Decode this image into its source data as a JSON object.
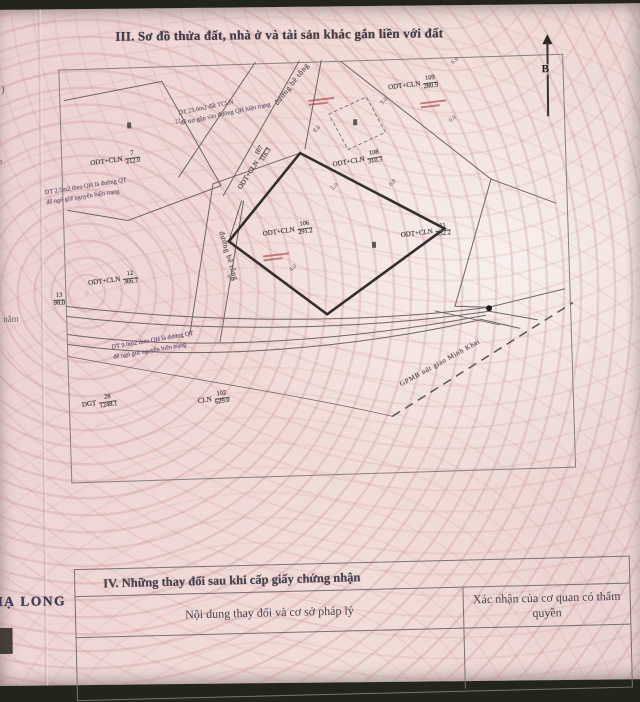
{
  "header": {
    "section_title": "III. Sơ đồ thửa đất, nhà ở và tài sản khác gắn liền với đất"
  },
  "margin": {
    "bracket": ")",
    "text_ao": "ao",
    "text_nam": "năm",
    "stamp": "HẠ LONG"
  },
  "north_label": "B",
  "map": {
    "road_labels": [
      {
        "text": "đường bê tông",
        "x": 206,
        "y": 16,
        "rot": -50
      },
      {
        "text": "đường bê tông",
        "x": 138,
        "y": 186,
        "rot": 75
      }
    ],
    "parcels": [
      {
        "code": "ODT+CLN",
        "num": "7",
        "area": "212.0",
        "x": 28,
        "y": 84,
        "rot": -6
      },
      {
        "code": "ODT+CLN",
        "num": "107",
        "area": "116.3",
        "x": 166,
        "y": 96,
        "rot": -55
      },
      {
        "code": "ODT+CLN",
        "num": "106",
        "area": "291.2",
        "x": 198,
        "y": 160,
        "rot": -6
      },
      {
        "code": "ODT+CLN",
        "num": "109",
        "area": "280.9",
        "x": 328,
        "y": 18,
        "rot": -5
      },
      {
        "code": "ODT+CLN",
        "num": "108",
        "area": "310.3",
        "x": 270,
        "y": 92,
        "rot": -8
      },
      {
        "code": "ODT+CLN",
        "num": "11",
        "area": "532.2",
        "x": 336,
        "y": 166,
        "rot": -5
      },
      {
        "code": "ODT+CLN",
        "num": "12",
        "area": "366.7",
        "x": 22,
        "y": 204,
        "rot": -5
      },
      {
        "code": "",
        "num": "13",
        "area": "98.0",
        "x": -16,
        "y": 222,
        "rot": 0
      },
      {
        "code": "DGT",
        "num": "28",
        "area": "1248.1",
        "x": 12,
        "y": 326,
        "rot": -6
      },
      {
        "code": "CLN",
        "num": "102",
        "area": "629.0",
        "x": 128,
        "y": 326,
        "rot": -6
      }
    ],
    "notes": [
      {
        "lines": [
          "DT 23.0m2 đất TCLN",
          "để trợ gộp vào đường QH hiện trạng"
        ],
        "x": 118,
        "y": 34,
        "rot": -10,
        "color": "#6e5d6e"
      },
      {
        "lines": [
          "DT 2.5m2 theo QH là đường QT",
          "để ngỏ giữ nguyên hiện trạng"
        ],
        "x": -18,
        "y": 112,
        "rot": -7,
        "color": "#6e5d6e"
      },
      {
        "lines": [
          "DT 9.0m2 theo QH là đường QT",
          "để ngỏ giữ nguyên hiện trạng"
        ],
        "x": 44,
        "y": 268,
        "rot": -8,
        "color": "#6b5574"
      }
    ],
    "dashed_road_label": {
      "text": "GPMB nút giao Minh Khai",
      "x": 326,
      "y": 300,
      "rot": -27
    },
    "edge_numbers": [
      {
        "t": "9.8",
        "x": 320,
        "y": 38,
        "r": -40
      },
      {
        "t": "6.9",
        "x": 392,
        "y": 0,
        "r": -35
      },
      {
        "t": "6.0",
        "x": 388,
        "y": 58,
        "r": -35
      },
      {
        "t": "6.8",
        "x": 326,
        "y": 120,
        "r": -40
      },
      {
        "t": "5.0",
        "x": 268,
        "y": 122,
        "r": -40
      },
      {
        "t": "8.8",
        "x": 252,
        "y": 64,
        "r": -40
      },
      {
        "t": "4.0",
        "x": 224,
        "y": 202,
        "r": -45
      },
      {
        "t": "9.0",
        "x": 160,
        "y": 210,
        "r": 40
      },
      {
        "t": "22",
        "x": 114,
        "y": 52,
        "r": -15
      }
    ],
    "house_markers": [
      {
        "x": 66,
        "y": 54
      },
      {
        "x": 292,
        "y": 58
      },
      {
        "x": 307,
        "y": 181
      }
    ],
    "red_marks": [
      {
        "x": 198,
        "y": 190
      },
      {
        "x": 248,
        "y": 36
      },
      {
        "x": 360,
        "y": 42
      }
    ]
  },
  "section4": {
    "title": "IV. Những thay đổi sau khi cấp giấy chứng nhận",
    "col_content": "Nội dung thay đổi và cơ sở pháp lý",
    "col_confirm": "Xác nhận của cơ quan có thẩm quyền"
  }
}
